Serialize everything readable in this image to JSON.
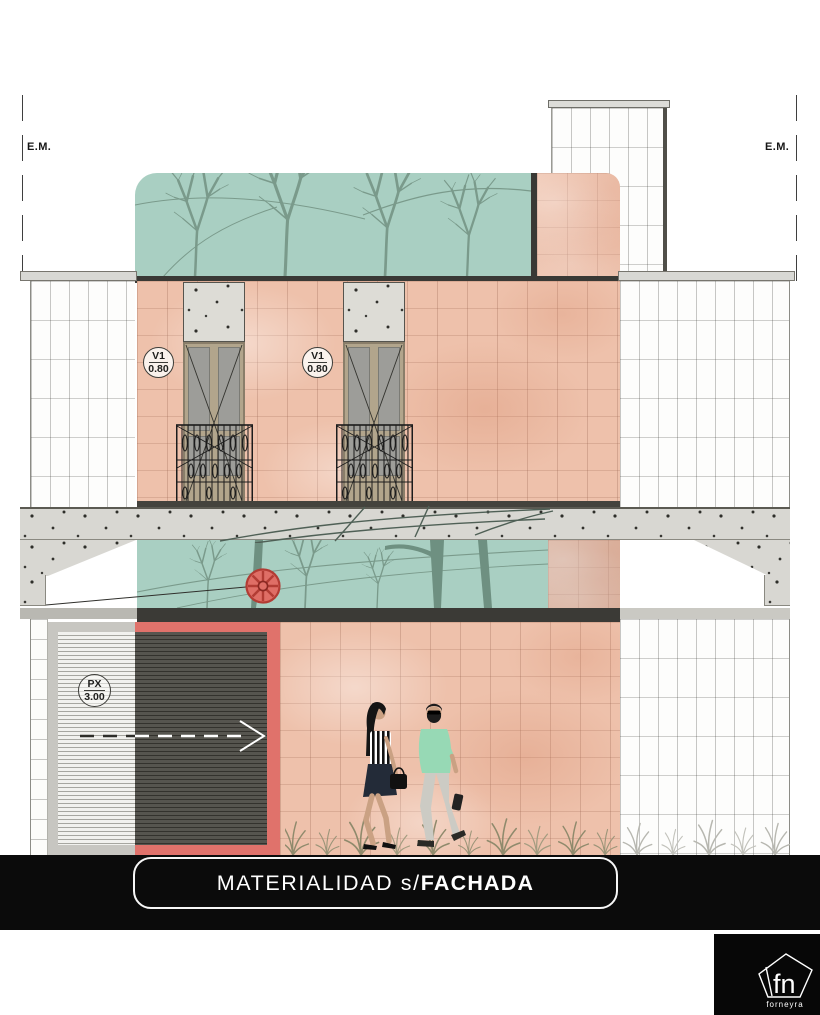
{
  "sheet": {
    "property_line_labels": {
      "left": "E.M.",
      "right": "E.M."
    },
    "window_tags": [
      {
        "code": "V1",
        "dimension": "0.80"
      },
      {
        "code": "V1",
        "dimension": "0.80"
      }
    ],
    "door_tag": {
      "code": "PX",
      "dimension": "3.00"
    },
    "title": {
      "light": "MATERIALIDAD s/",
      "bold": "FACHADA"
    },
    "logo": {
      "monogram": "fn",
      "studio": "forneyra"
    },
    "materials": {
      "brick_pink": "#eec1ab",
      "glass_teal": "#a9cfc2",
      "concrete": "#d8d7d2",
      "accent_coral": "#e0726b",
      "band_dark": "#3b3a36",
      "ground_black": "#0b0b0b",
      "tile_white": "#fdfdfc",
      "shirt_mint": "#97d9b5"
    }
  }
}
